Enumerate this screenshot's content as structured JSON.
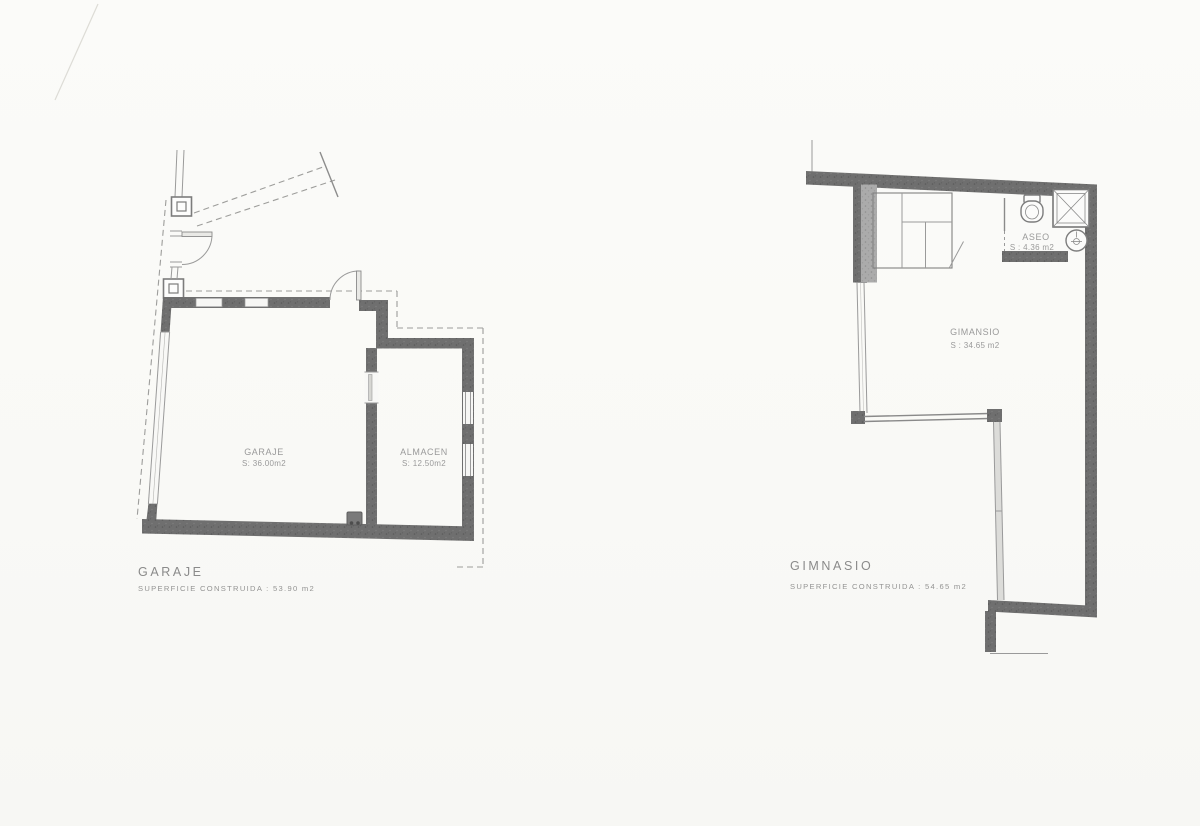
{
  "left_plan": {
    "title": "GARAJE",
    "area_label": "SUPERFICIE CONSTRUIDA : 53.90 m2",
    "rooms": {
      "garaje": {
        "name": "GARAJE",
        "area": "S: 36.00m2"
      },
      "almacen": {
        "name": "ALMACEN",
        "area": "S: 12.50m2"
      }
    }
  },
  "right_plan": {
    "title": "GIMNASIO",
    "area_label": "SUPERFICIE CONSTRUIDA : 54.65 m2",
    "rooms": {
      "gimnasio": {
        "name": "GIMANSIO",
        "area": "S : 34.65 m2"
      },
      "aseo": {
        "name": "ASEO",
        "area": "S : 4.36 m2"
      }
    }
  },
  "colors": {
    "wall": "#6f6f6f",
    "wall_light": "#ababab",
    "line": "#9a9a9a",
    "text": "#8f8f8f",
    "paper": "#fbfbf9"
  }
}
